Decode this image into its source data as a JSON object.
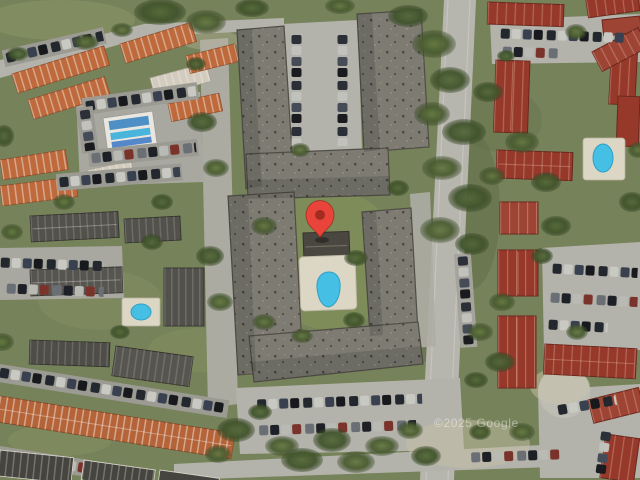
{
  "map": {
    "view_type": "satellite-imagery",
    "watermark": "©2025 Google",
    "marker": {
      "name": "location-pin",
      "transform": "translate(320,238)",
      "tip_x": 320,
      "tip_y": 238,
      "color": "#E8443A",
      "inner_color": "#A32B20"
    },
    "palette": {
      "pool_blue": "#45C0E4",
      "pool_edge": "#2E9FC4",
      "deck": "#DCD6C5",
      "grass": "#76825A",
      "tree_dark": "#41542C",
      "pavement": "#B4B3AB",
      "gray_roof": "#7D7B72",
      "dark_slab": "#4E4D47",
      "red_roof": "#96392B",
      "orange_roof": "#BE6A3C",
      "clubhouse_blue": "#4E8FC6"
    }
  }
}
